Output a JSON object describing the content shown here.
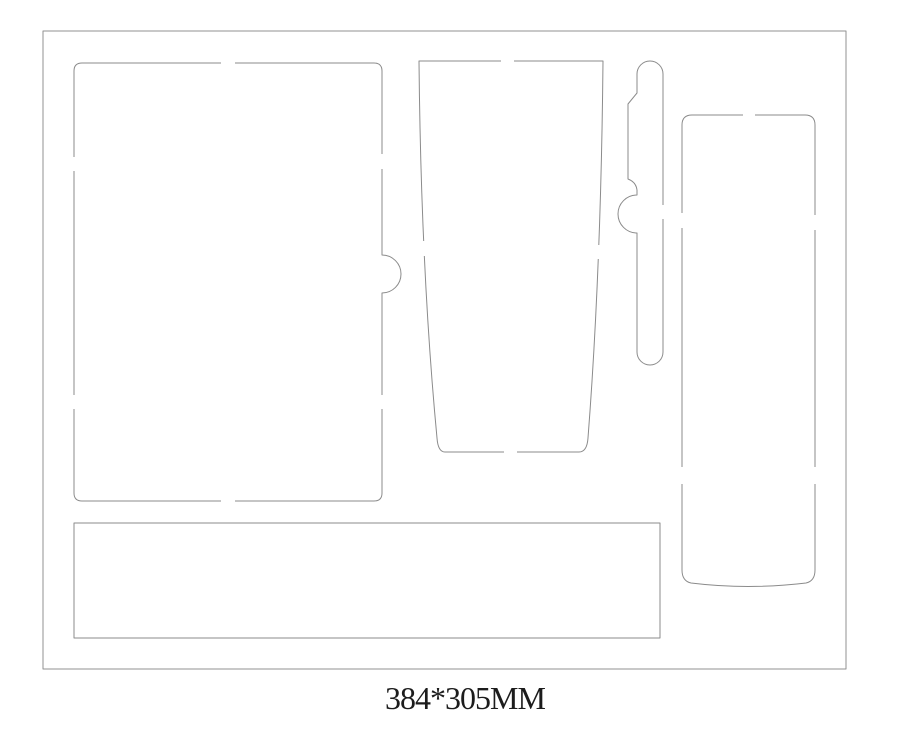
{
  "window": {
    "width": 900,
    "height": 732,
    "background": "#ffffff"
  },
  "diagram": {
    "title_label": "384*305MM",
    "label_color": "#1c1c1c",
    "label_x": 465,
    "label_y": 709,
    "stroke_color": "#8b8b8b",
    "border_color": "#919191",
    "gap_fill": "#ffffff",
    "pieces": [
      {
        "name": "outer-board-edge",
        "path": "M43,31 L846,31 L846,669 L43,669 Z",
        "stroke": "#919191"
      },
      {
        "name": "notebook-slot",
        "path": "M74,71 Q74,63 82,63 L374,63 Q382,63 382,71 L382,255 A19,19 0 0 1 382,293 L382,493 Q382,501 374,501 L82,501 Q74,501 74,493 Z",
        "stroke": "#8b8b8b"
      },
      {
        "name": "tumbler-slot",
        "path": "M419,61 L603,61 Q601,270 588,438 Q587,452 579,452 L445,452 Q438,452 437,438 Q421,270 419,61 Z",
        "stroke": "#8b8b8b"
      },
      {
        "name": "pen-slot",
        "path": "M637,74 A13,13 0 0 1 663,74 L663,352 A13,13 0 0 1 637,352 L637,233 A19,19 0 0 1 637,195 L637,190 Q636,182 628,179 L628,104 L637,93 Z",
        "stroke": "#8b8b8b"
      },
      {
        "name": "tall-slot",
        "path": "M682,125 Q682,115 692,115 L805,115 Q815,115 815,125 L815,570 Q815,581 806,583 Q748,590 691,583 Q682,581 682,570 Z",
        "stroke": "#8b8b8b"
      },
      {
        "name": "bottom-slot",
        "path": "M74,523 L660,523 L660,638 L74,638 Z",
        "stroke": "#8b8b8b"
      }
    ],
    "bridge_gaps": [
      {
        "piece": "notebook-slot",
        "x": 221,
        "y": 58,
        "w": 14,
        "h": 10
      },
      {
        "piece": "notebook-slot",
        "x": 221,
        "y": 496,
        "w": 14,
        "h": 10
      },
      {
        "piece": "notebook-slot",
        "x": 69,
        "y": 157,
        "w": 10,
        "h": 14
      },
      {
        "piece": "notebook-slot",
        "x": 69,
        "y": 395,
        "w": 10,
        "h": 14
      },
      {
        "piece": "notebook-slot",
        "x": 377,
        "y": 154,
        "w": 10,
        "h": 15
      },
      {
        "piece": "notebook-slot",
        "x": 377,
        "y": 395,
        "w": 10,
        "h": 14
      },
      {
        "piece": "tumbler-slot",
        "x": 501,
        "y": 56,
        "w": 13,
        "h": 10
      },
      {
        "piece": "tumbler-slot",
        "x": 504,
        "y": 447,
        "w": 13,
        "h": 10
      },
      {
        "piece": "tumbler-slot",
        "x": 416,
        "y": 241,
        "w": 12,
        "h": 15
      },
      {
        "piece": "tumbler-slot",
        "x": 593,
        "y": 245,
        "w": 12,
        "h": 14
      },
      {
        "piece": "pen-slot",
        "x": 658,
        "y": 205,
        "w": 10,
        "h": 14
      },
      {
        "piece": "tall-slot",
        "x": 743,
        "y": 110,
        "w": 12,
        "h": 10
      },
      {
        "piece": "tall-slot",
        "x": 677,
        "y": 213,
        "w": 10,
        "h": 15
      },
      {
        "piece": "tall-slot",
        "x": 677,
        "y": 467,
        "w": 10,
        "h": 17
      },
      {
        "piece": "tall-slot",
        "x": 810,
        "y": 215,
        "w": 10,
        "h": 15
      },
      {
        "piece": "tall-slot",
        "x": 810,
        "y": 467,
        "w": 10,
        "h": 17
      }
    ]
  }
}
